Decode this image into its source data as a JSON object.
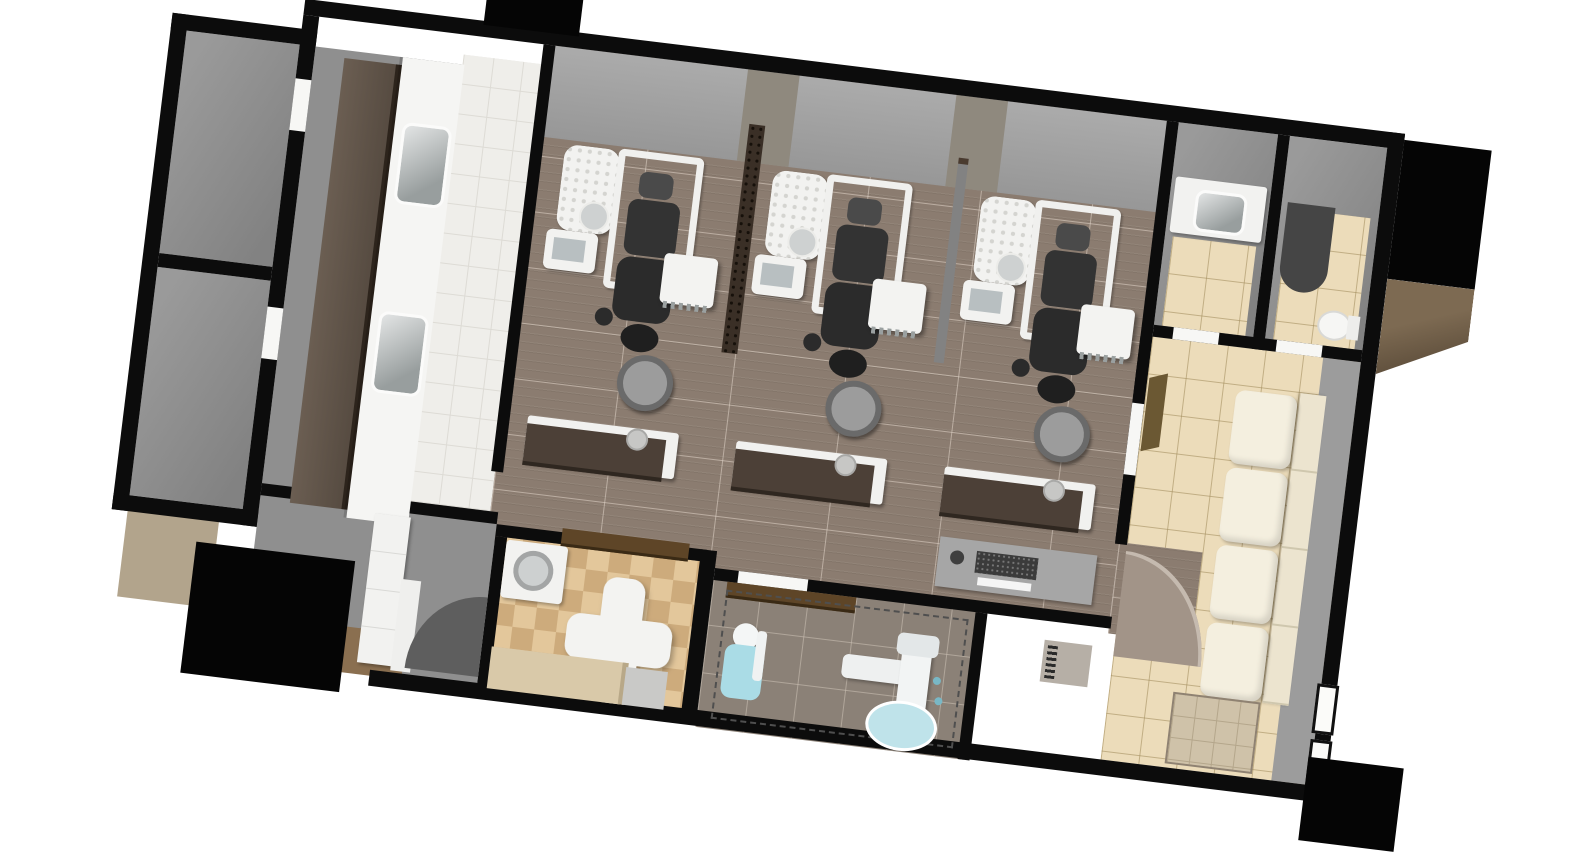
{
  "scene": {
    "description": "3D overhead architectural rendering of a dental clinic floor plan, rotated about 7 degrees clockwise on a white background",
    "operatories": 3,
    "dental_chairs": 3,
    "operatory_stools": 3,
    "rear_credenzas": 3,
    "sterilization_sinks": 2,
    "bathrooms": 2,
    "toilets": 1,
    "vanity_sinks": 1,
    "waiting_sofa_seats": 4,
    "xray_machines": 1,
    "xray_patient_chairs": 1,
    "entry_door_panels": 2,
    "rotation_deg": 7
  },
  "colors": {
    "wall": "#0c0c0c",
    "black_block": "#050505",
    "floor_gray": "#8f8f8f",
    "floor_plank": "#8b7c70",
    "floor_white": "#efeeea",
    "floor_beige": "#ecdcba",
    "floor_xray": "#8b8177",
    "checker_light": "#e3c79b",
    "checker_dark": "#cdab7c",
    "screen_dark": "#3a2f26",
    "counter": "#f5f5f3",
    "credenza": "#4c4037",
    "cabinet": "#5f5347",
    "sofa": "#f4efdf",
    "sofa_back": "#ece4cf",
    "arch": "#a29488",
    "wood": "#5e4527",
    "door_olive": "#6b5833",
    "mat": "#cfc2a9",
    "bench": "#d9c9a9",
    "desk": "#a6a6a6",
    "keyboard": "#3b3b3b",
    "chair_blue": "#aadce6",
    "xray_base_blue": "#bfe3ea",
    "exterior_brown_light": "#7d6a52",
    "exterior_brown_dark": "#4e4030",
    "tan": "#b2a48c",
    "background": "#ffffff"
  }
}
